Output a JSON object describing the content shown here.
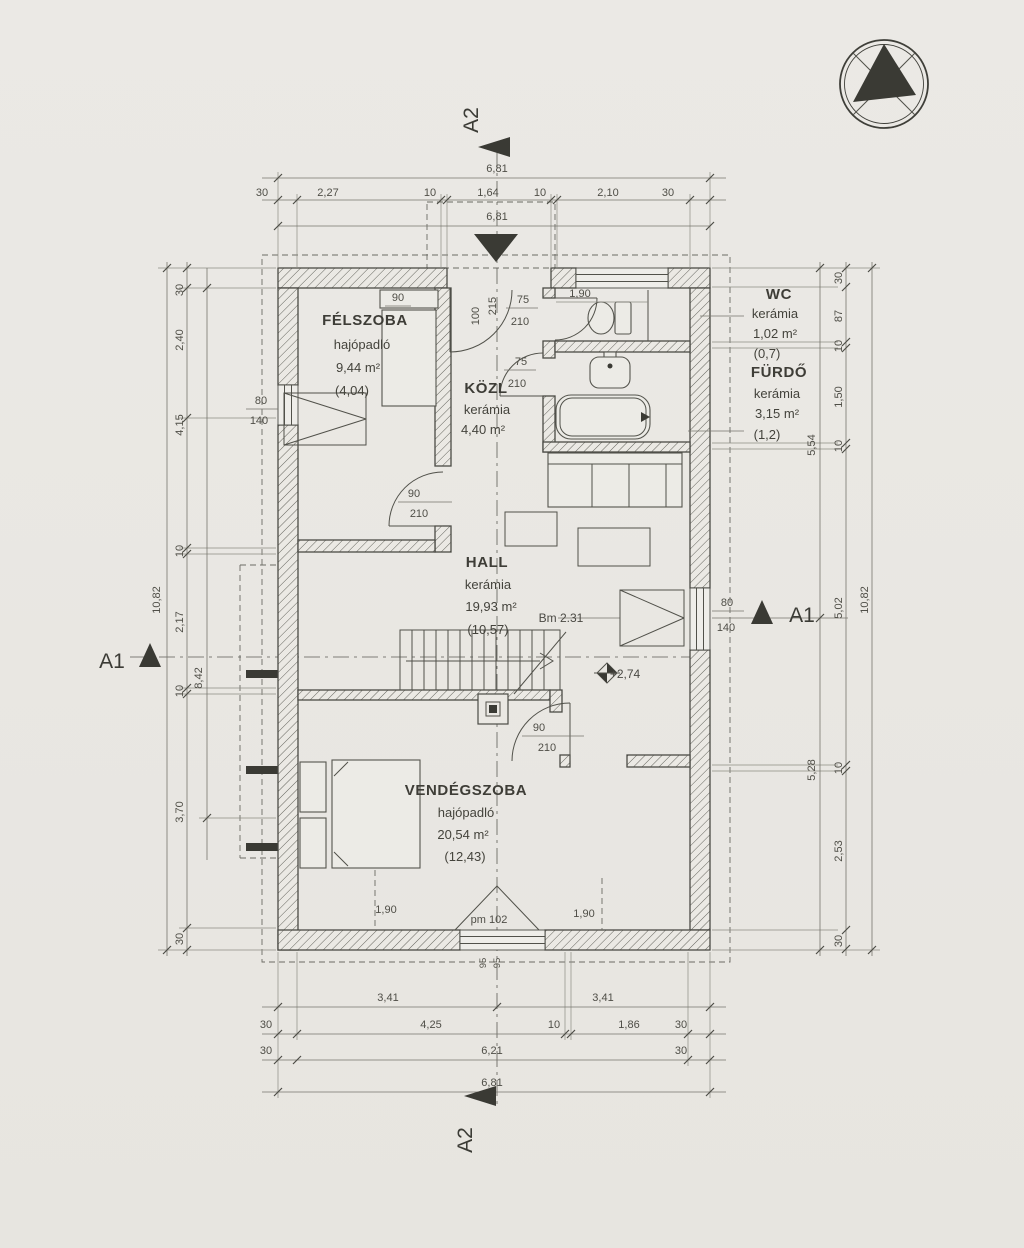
{
  "page": {
    "background": "#e9e7e3",
    "ink": "#4a4a44"
  },
  "markers": {
    "a1": "A1",
    "a2": "A2"
  },
  "rooms": {
    "felszoba": {
      "name": "FÉLSZOBA",
      "finish": "hajópadló",
      "area": "9,44 m²",
      "net": "(4,04)"
    },
    "kozl": {
      "name": "KÖZL",
      "finish": "kerámia",
      "area": "4,40 m²"
    },
    "wc": {
      "name": "WC",
      "finish": "kerámia",
      "area": "1,02 m²",
      "net": "(0,7)"
    },
    "furdo": {
      "name": "FÜRDŐ",
      "finish": "kerámia",
      "area": "3,15 m²",
      "net": "(1,2)"
    },
    "hall": {
      "name": "HALL",
      "finish": "kerámia",
      "area": "19,93 m²",
      "net": "(10,57)"
    },
    "vendegszoba": {
      "name": "VENDÉGSZOBA",
      "finish": "hajópadló",
      "area": "20,54 m²",
      "net": "(12,43)"
    }
  },
  "dims": {
    "top": {
      "total": "6,81",
      "run": [
        "30",
        "2,27",
        "10",
        "1,64",
        "10",
        "2,10",
        "30"
      ],
      "inner_total": "6,81"
    },
    "bottom": {
      "halves": [
        "3,41",
        "3,41"
      ],
      "run": [
        "30",
        "4,25",
        "10",
        "1,86",
        "30"
      ],
      "run2": [
        "30",
        "6,21",
        "30"
      ],
      "total": "6,81"
    },
    "left": {
      "total": "10,82",
      "run": [
        "30",
        "2,40",
        "4,15",
        "10",
        "2,17",
        "10",
        "3,70",
        "30"
      ],
      "inner": "8,42"
    },
    "right": {
      "total": "10,82",
      "run": [
        "30",
        "87",
        "10",
        "1,50",
        "10",
        "5,02",
        "10",
        "2,53",
        "30"
      ],
      "upper": "5,54",
      "lower": "5,28"
    }
  },
  "openings": {
    "small_window": {
      "w": "80",
      "h": "140"
    },
    "door": {
      "w": "90",
      "h": "210"
    },
    "small_door": {
      "w": "75",
      "h": "210"
    },
    "entry": {
      "w": "100",
      "h": "215"
    },
    "wardrobe_w": "90",
    "top_window": "1,90"
  },
  "annotations": {
    "beam": "Bm 2.31",
    "level": "+2,74",
    "parapet": "pm 102",
    "sill_a": "95",
    "sill_b": "95",
    "win_left": "1,90",
    "win_right": "1,90"
  }
}
